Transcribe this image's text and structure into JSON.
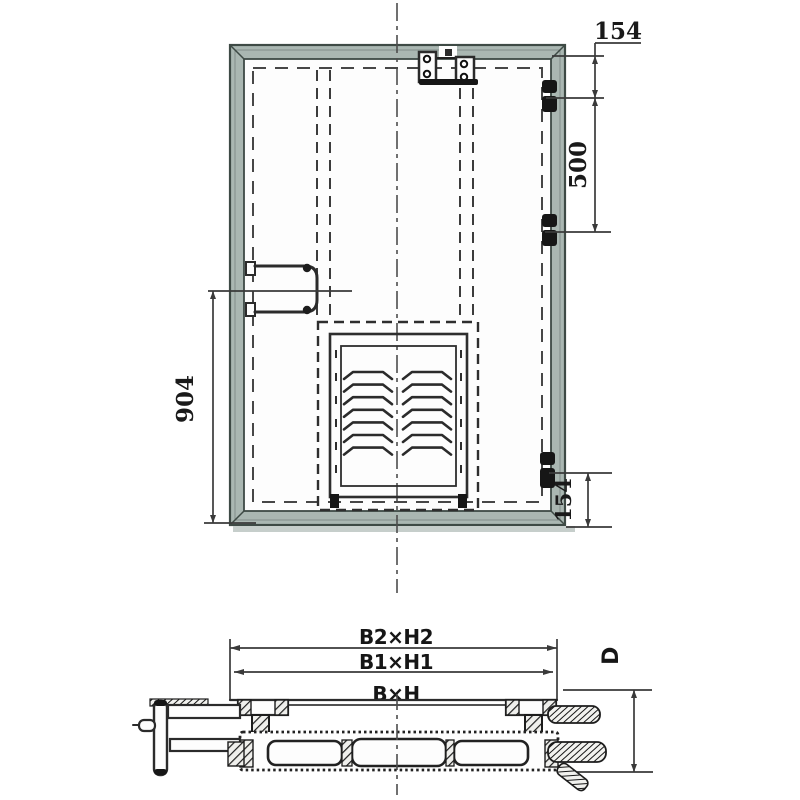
{
  "drawing": {
    "front_view": {
      "dim_top_hinge_offset": "154",
      "dim_hinge_spacing": "500",
      "dim_handle_to_bottom": "904",
      "dim_bottom_hinge_offset": "154"
    },
    "section_view": {
      "dim_outer": "B2×H2",
      "dim_frame": "B1×H1",
      "dim_clear_opening": "B×H",
      "dim_depth": "D"
    },
    "colors": {
      "line": "#2b2b2b",
      "dim": "#3a3a3a",
      "frame_fill": "#aab7b2",
      "background": "#ffffff"
    }
  }
}
